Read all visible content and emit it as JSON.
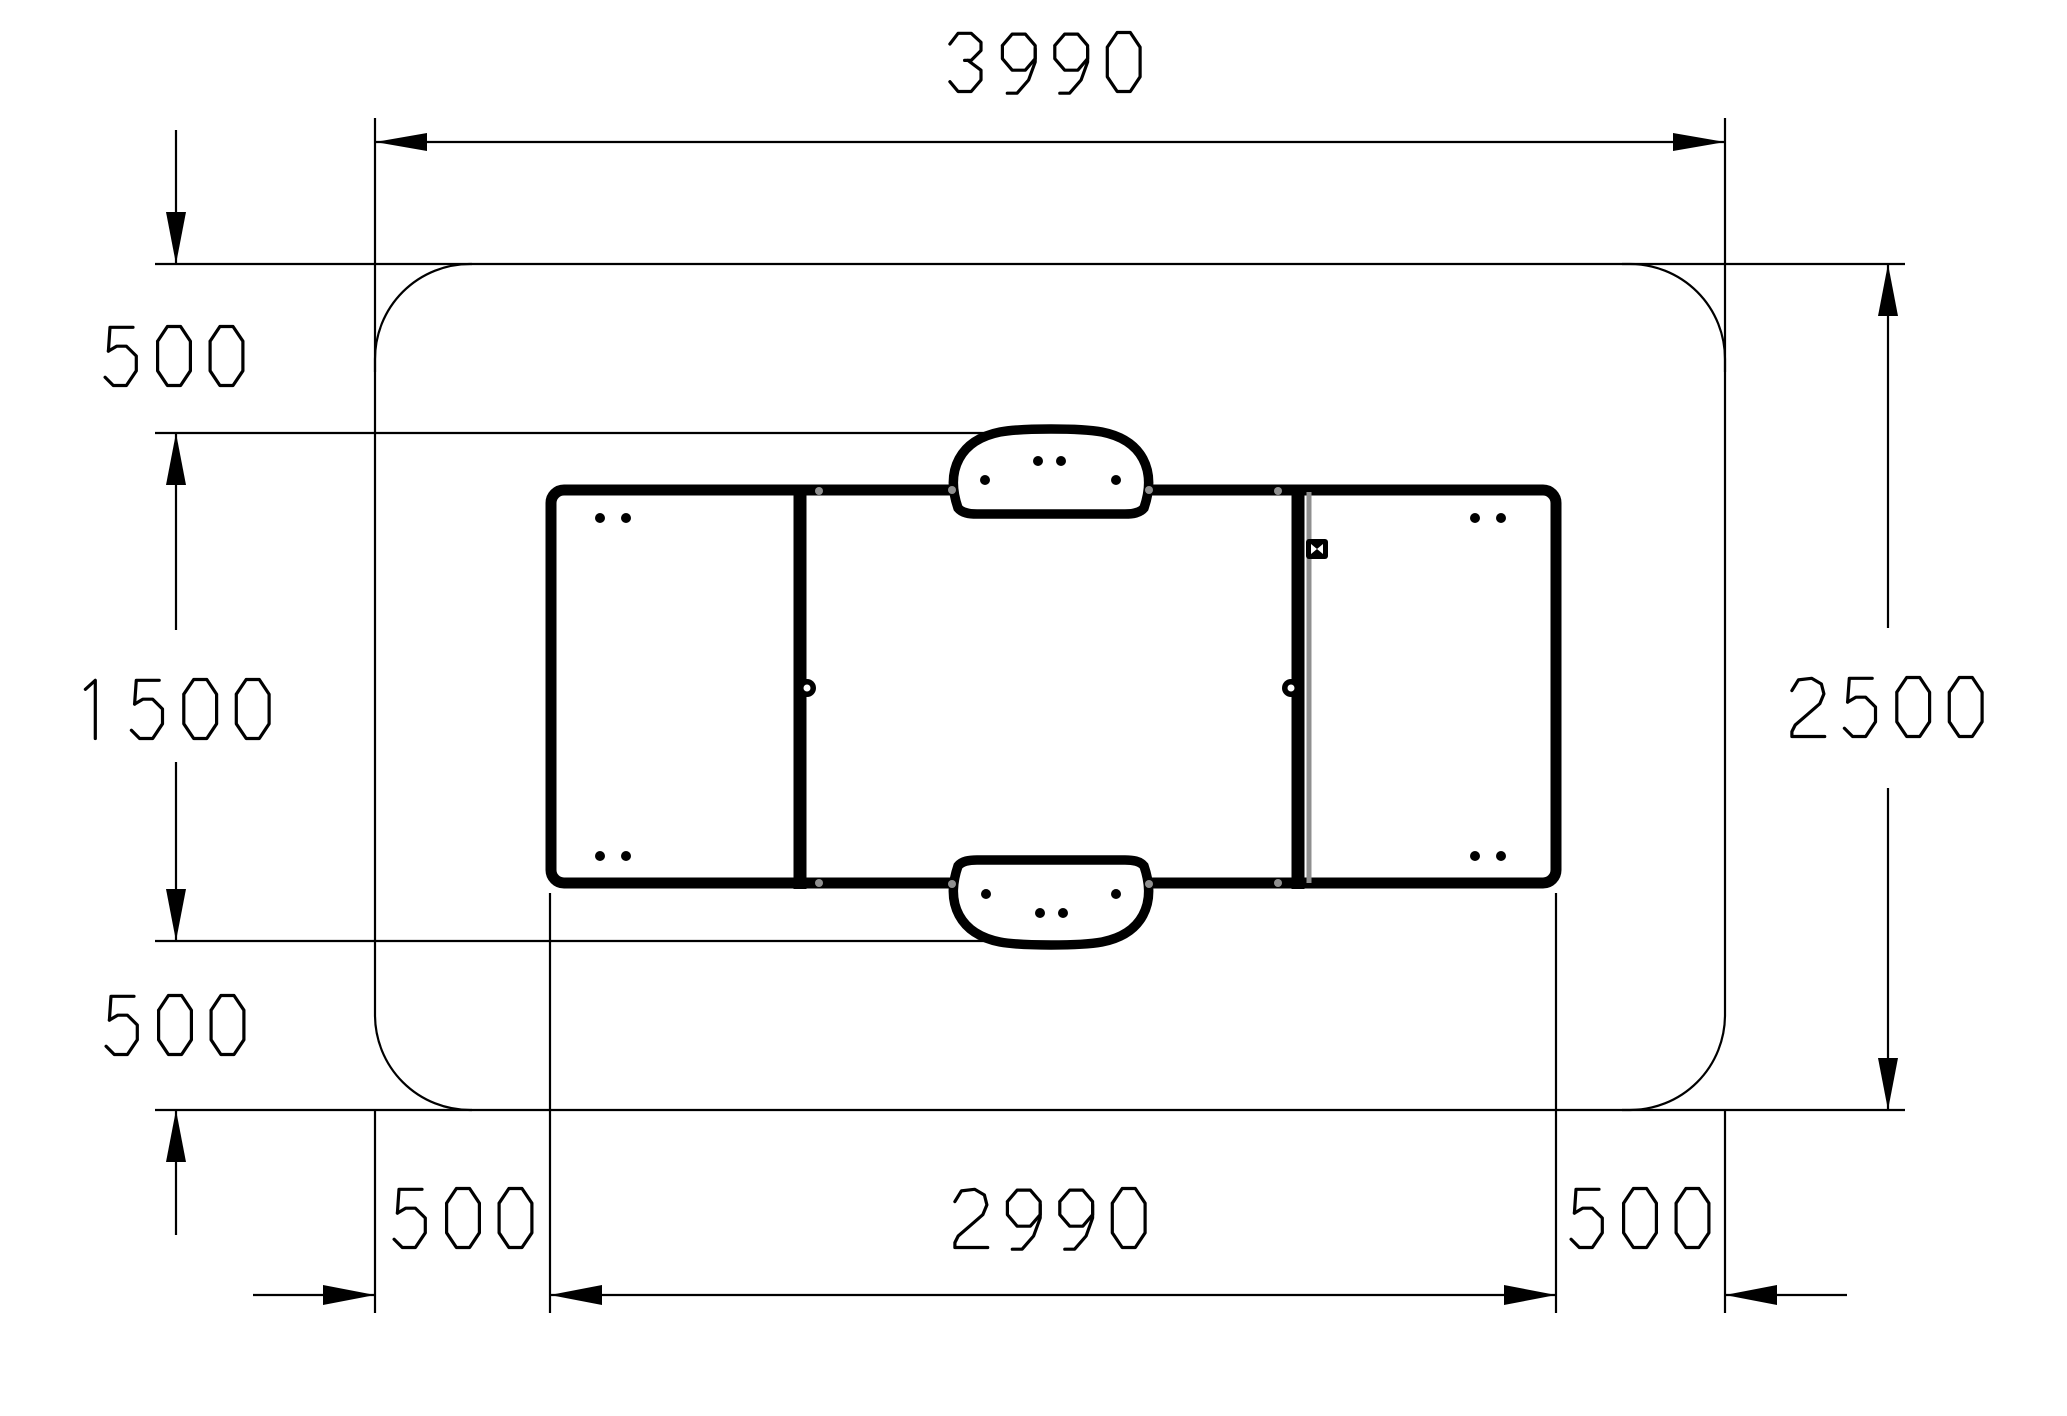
{
  "drawing": {
    "type": "plan-view-dimension-drawing",
    "dims": {
      "overall_width": "3990",
      "overall_height": "2500",
      "clearance_top": "500",
      "equipment_height": "1500",
      "clearance_bottom": "500",
      "clearance_left": "500",
      "equipment_width": "2990",
      "clearance_right": "500"
    },
    "colors": {
      "line": "#000000",
      "hardware_gray": "#8f8f8f",
      "background": "#ffffff"
    }
  }
}
